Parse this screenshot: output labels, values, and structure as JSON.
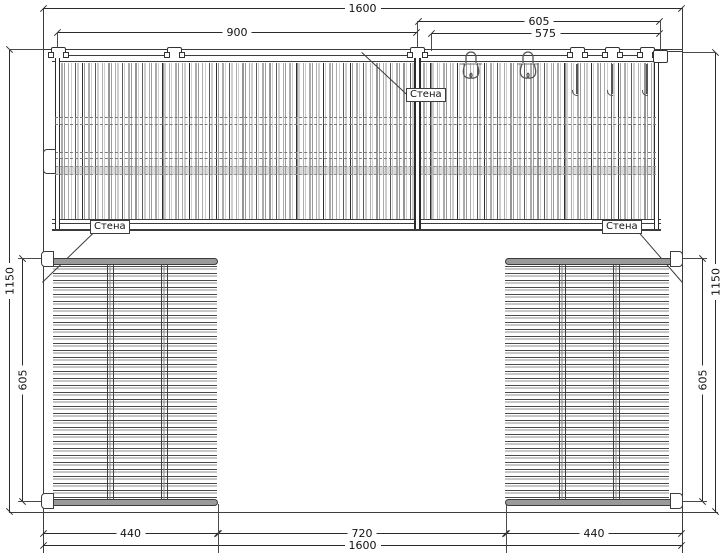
{
  "drawing": {
    "type": "wall-elevation plan of slatted panels with hooks",
    "colors": {
      "background": "#ffffff",
      "line": "#3c3c3c",
      "dimension": "#2b2b2b",
      "panel_bar": "#9a9a9a",
      "slat_dark": "#555555",
      "slat_light": "#999999"
    },
    "dimensions": {
      "top_total": "1600",
      "top_left_section": "900",
      "top_right_section": "605",
      "top_right_inner": "575",
      "left_overall": "1150",
      "left_lower": "605",
      "right_overall": "1150",
      "right_lower": "605",
      "bottom_left": "440",
      "bottom_middle": "720",
      "bottom_right": "440",
      "bottom_total": "1600"
    },
    "labels": {
      "wall_top": "Стена",
      "wall_left": "Стена",
      "wall_right": "Стена"
    },
    "icons": {
      "mounting_clamp": "staple-shaped wall clamp on top rail",
      "double_hook": "pair of coat hooks with rounded plate",
      "single_hook": "long-stem hook hanging from rail",
      "wall_clip": "side mounting clip to wall"
    }
  }
}
